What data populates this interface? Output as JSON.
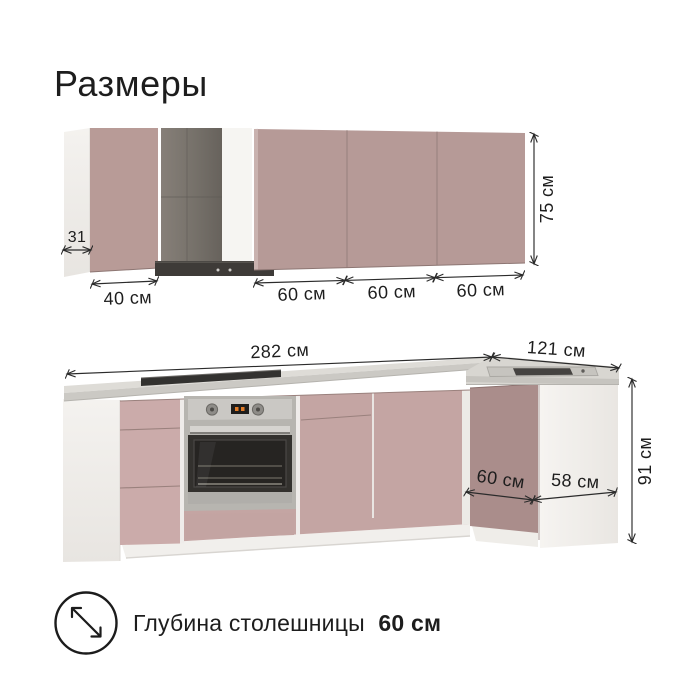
{
  "title": "Размеры",
  "colors": {
    "upper_cabinet_front": "#b69a97",
    "base_cabinet_front": "#c4a5a3",
    "drawer_front": "#cbabaa",
    "corner_side_panel": "#aa8d8b",
    "white_panel": "#f2f0ed",
    "countertop": "#d8d6d1",
    "hood_gray": "#7b766f",
    "hood_canopy_dark": "#3e3b39",
    "oven_steel": "#b7b5b0",
    "dimension_ink": "#2b2b2b"
  },
  "upper_cabinets": {
    "depth_label": "31",
    "widths": [
      "40 см",
      "60 см",
      "60 см",
      "60 см"
    ],
    "height_label": "75 см"
  },
  "base_cabinets": {
    "total_width_label": "282 см",
    "return_width_label": "121 см",
    "height_label": "91 см",
    "corner_depth_label": "60 см",
    "end_width_label": "58 см"
  },
  "footer": {
    "icon": "diagonal-resize-arrow-icon",
    "label": "Глубина столешницы",
    "value_bold": "60 см"
  }
}
